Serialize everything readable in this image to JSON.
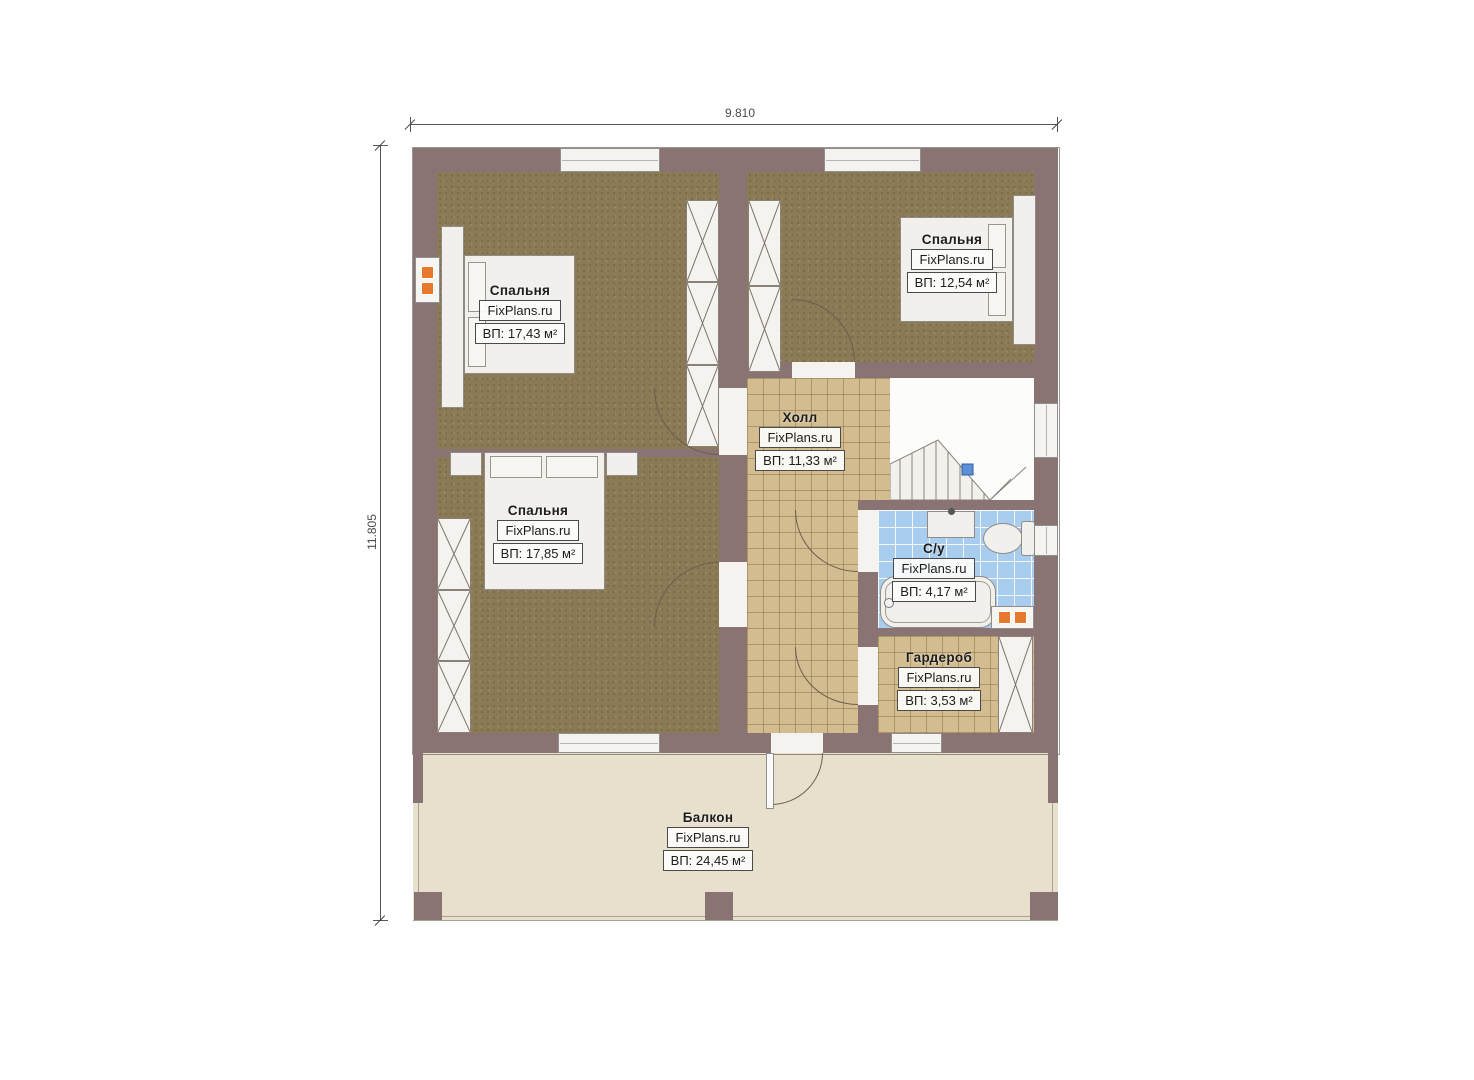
{
  "dimensions": {
    "width_label": "9.810",
    "height_label": "11.805"
  },
  "rooms": {
    "bedroom_tl": {
      "name": "Спальня",
      "brand": "FixPlans.ru",
      "area": "ВП: 17,43 м²"
    },
    "bedroom_tr": {
      "name": "Спальня",
      "brand": "FixPlans.ru",
      "area": "ВП: 12,54 м²"
    },
    "bedroom_bl": {
      "name": "Спальня",
      "brand": "FixPlans.ru",
      "area": "ВП: 17,85 м²"
    },
    "hall": {
      "name": "Холл",
      "brand": "FixPlans.ru",
      "area": "ВП: 11,33 м²"
    },
    "bathroom": {
      "name": "С/у",
      "brand": "FixPlans.ru",
      "area": "ВП: 4,17 м²"
    },
    "wardrobe": {
      "name": "Гардероб",
      "brand": "FixPlans.ru",
      "area": "ВП: 3,53 м²"
    },
    "balcony": {
      "name": "Балкон",
      "brand": "FixPlans.ru",
      "area": "ВП: 24,45 м²"
    }
  },
  "colors": {
    "wall": "#8a7473",
    "bedroom_floor": "#8a7a55",
    "tile_floor": "#d3bd90",
    "bath_floor": "#a9cdee",
    "balcony_floor": "#e7e0cd",
    "vent": "#e8782d",
    "stair_marker": "#5b8fd6"
  }
}
